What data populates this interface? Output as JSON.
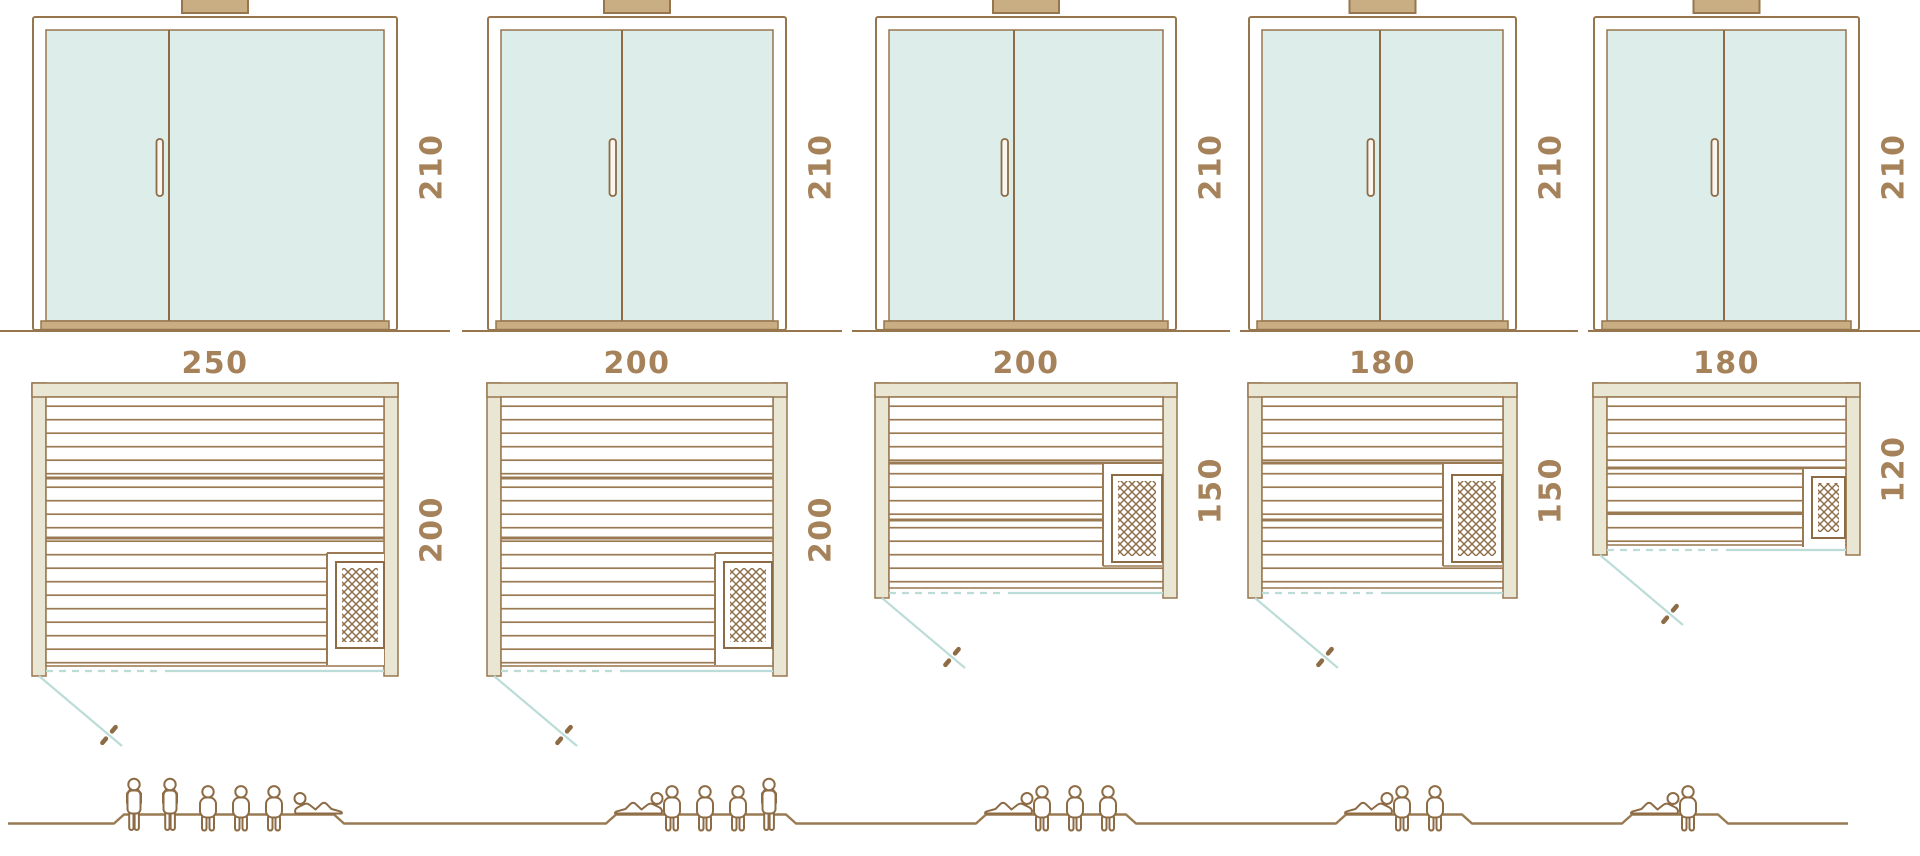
{
  "diagram": {
    "title": "sauna size comparison",
    "views": [
      "front elevation",
      "floor plan",
      "capacity figures"
    ],
    "unit": "cm"
  },
  "saunas": [
    {
      "name": "sauna-250x200",
      "height_cm": "210",
      "width_cm": "250",
      "depth_cm": "200",
      "capacity": 6,
      "occupants": [
        "standing",
        "standing",
        "seated",
        "seated",
        "seated",
        "reclining"
      ]
    },
    {
      "name": "sauna-200x200",
      "height_cm": "210",
      "width_cm": "200",
      "depth_cm": "200",
      "capacity": 5,
      "occupants": [
        "reclining",
        "seated",
        "seated",
        "seated",
        "standing"
      ]
    },
    {
      "name": "sauna-200x150",
      "height_cm": "210",
      "width_cm": "200",
      "depth_cm": "150",
      "capacity": 4,
      "occupants": [
        "reclining",
        "seated",
        "seated",
        "seated"
      ]
    },
    {
      "name": "sauna-180x150",
      "height_cm": "210",
      "width_cm": "180",
      "depth_cm": "150",
      "capacity": 3,
      "occupants": [
        "reclining",
        "seated",
        "seated"
      ]
    },
    {
      "name": "sauna-180x120",
      "height_cm": "210",
      "width_cm": "180",
      "depth_cm": "120",
      "capacity": 2,
      "occupants": [
        "reclining",
        "seated"
      ]
    }
  ],
  "colors": {
    "outline_brown": "#8d6b45",
    "line_brown": "#97764e",
    "dimension_text": "#a5825a",
    "wall_beige": "#e9e6d4",
    "wood_tan": "#c9ad83",
    "glass_mint": "#ddeeea",
    "door_swing_teal": "#bcdcd8",
    "background": "#ffffff"
  }
}
